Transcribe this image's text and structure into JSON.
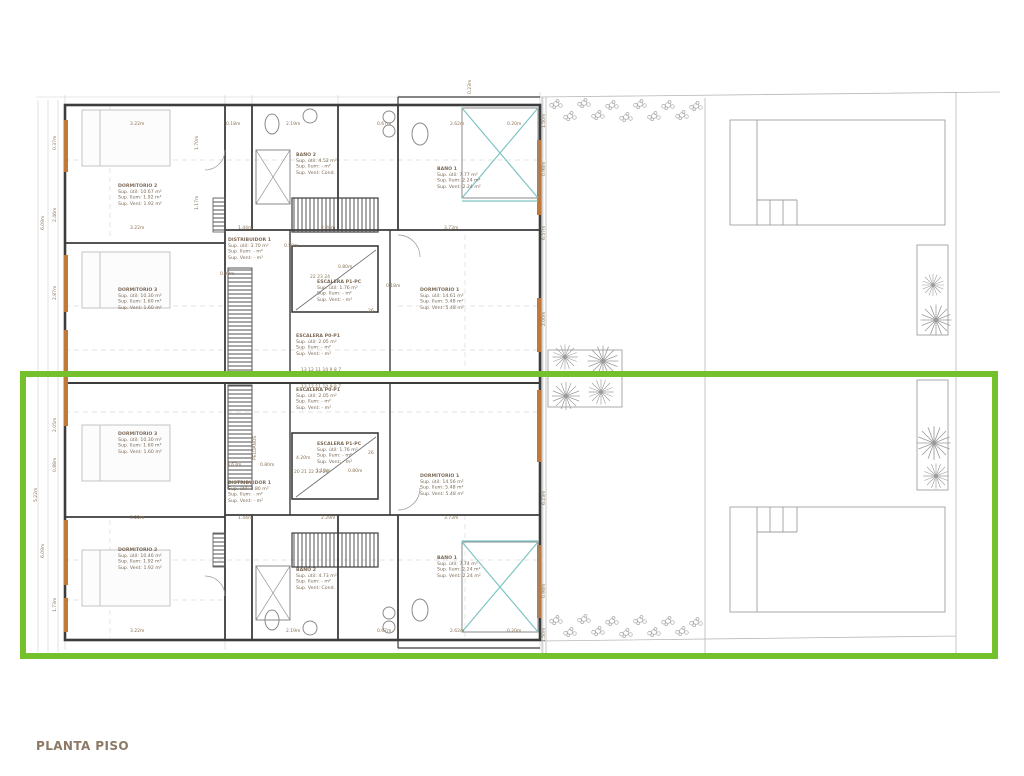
{
  "title": "PLANTA PISO",
  "colors": {
    "highlight_green": "#74c12d",
    "wall_dark": "#3c3c3c",
    "window_orange": "#c1793a",
    "fixture_teal": "#7fc4c4",
    "annotation_brown": "#8a7355",
    "title_brown": "#8c7a66"
  },
  "rooms": [
    {
      "x": 118,
      "y": 183,
      "name": "DORMITORIO 2",
      "lines": [
        "Sup. útil: 10.67 m²",
        "Sup. Ilum: 1.92 m²",
        "Sup. Vent: 1.92 m²"
      ]
    },
    {
      "x": 296,
      "y": 152,
      "name": "BAÑO 2",
      "lines": [
        "Sup. útil: 4.52 m²",
        "Sup. Ilum: - m²",
        "Sup. Vent: Cond."
      ]
    },
    {
      "x": 437,
      "y": 166,
      "name": "BAÑO 1",
      "lines": [
        "Sup. útil: 7.77 m²",
        "Sup. Ilum: 2.24 m²",
        "Sup. Vent: 2.24 m²"
      ]
    },
    {
      "x": 228,
      "y": 237,
      "name": "DISTRIBUIDOR 1",
      "lines": [
        "Sup. útil: 3.70 m²",
        "Sup. Ilum: - m²",
        "Sup. Vent: - m²"
      ]
    },
    {
      "x": 317,
      "y": 279,
      "name": "ESCALERA P1-PC",
      "lines": [
        "Sup. útil: 1.76 m²",
        "Sup. Ilum: - m²",
        "Sup. Vent: - m²"
      ]
    },
    {
      "x": 118,
      "y": 287,
      "name": "DORMITORIO 3",
      "lines": [
        "Sup. útil: 10.30 m²",
        "Sup. Ilum: 1.60 m²",
        "Sup. Vent: 1.60 m²"
      ]
    },
    {
      "x": 420,
      "y": 287,
      "name": "DORMITORIO 1",
      "lines": [
        "Sup. útil: 14.61 m²",
        "Sup. Ilum: 5.48 m²",
        "Sup. Vent: 5.48 m²"
      ]
    },
    {
      "x": 296,
      "y": 333,
      "name": "ESCALERA P0-P1",
      "lines": [
        "Sup. útil: 2.05 m²",
        "Sup. Ilum: - m²",
        "Sup. Vent: - m²"
      ]
    },
    {
      "x": 296,
      "y": 387,
      "name": "ESCALERA P0-P1",
      "lines": [
        "Sup. útil: 2.05 m²",
        "Sup. Ilum: - m²",
        "Sup. Vent: - m²"
      ]
    },
    {
      "x": 118,
      "y": 431,
      "name": "DORMITORIO 3",
      "lines": [
        "Sup. útil: 10.30 m²",
        "Sup. Ilum: 1.60 m²",
        "Sup. Vent: 1.60 m²"
      ]
    },
    {
      "x": 317,
      "y": 441,
      "name": "ESCALERA P1-PC",
      "lines": [
        "Sup. útil: 1.76 m²",
        "Sup. Ilum: - m²",
        "Sup. Vent: - m²"
      ]
    },
    {
      "x": 228,
      "y": 480,
      "name": "DISTRIBUIDOR 1",
      "lines": [
        "Sup. útil: 3.80 m²",
        "Sup. Ilum: - m²",
        "Sup. Vent: - m²"
      ]
    },
    {
      "x": 420,
      "y": 473,
      "name": "DORMITORIO 1",
      "lines": [
        "Sup. útil: 14.56 m²",
        "Sup. Ilum: 5.48 m²",
        "Sup. Vent: 5.48 m²"
      ]
    },
    {
      "x": 118,
      "y": 547,
      "name": "DORMITORIO 2",
      "lines": [
        "Sup. útil: 10.46 m²",
        "Sup. Ilum: 1.92 m²",
        "Sup. Vent: 1.92 m²"
      ]
    },
    {
      "x": 296,
      "y": 567,
      "name": "BAÑO 2",
      "lines": [
        "Sup. útil: 4.73 m²",
        "Sup. Ilum: - m²",
        "Sup. Vent: Cond."
      ]
    },
    {
      "x": 437,
      "y": 555,
      "name": "BAÑO 1",
      "lines": [
        "Sup. útil: 7.74 m²",
        "Sup. Ilum: 2.24 m²",
        "Sup. Vent: 2.24 m²"
      ]
    }
  ],
  "dimensions": [
    {
      "t": "3.22m",
      "x": 130,
      "y": 121,
      "r": 0
    },
    {
      "t": "0.18m",
      "x": 226,
      "y": 121,
      "r": 0
    },
    {
      "t": "2.19m",
      "x": 286,
      "y": 121,
      "r": 0
    },
    {
      "t": "0.67m",
      "x": 377,
      "y": 121,
      "r": 0
    },
    {
      "t": "2.62m",
      "x": 450,
      "y": 121,
      "r": 0
    },
    {
      "t": "0.20m",
      "x": 507,
      "y": 121,
      "r": 0
    },
    {
      "t": "3.22m",
      "x": 130,
      "y": 225,
      "r": 0
    },
    {
      "t": "1.44m",
      "x": 238,
      "y": 225,
      "r": 0
    },
    {
      "t": "2.28m",
      "x": 321,
      "y": 225,
      "r": 0
    },
    {
      "t": "3.73m",
      "x": 444,
      "y": 225,
      "r": 0
    },
    {
      "t": "0.59m",
      "x": 284,
      "y": 243,
      "r": 0
    },
    {
      "t": "0.90m",
      "x": 220,
      "y": 271,
      "r": 0
    },
    {
      "t": "0.80m",
      "x": 338,
      "y": 264,
      "r": 0
    },
    {
      "t": "0.18m",
      "x": 386,
      "y": 283,
      "r": 0
    },
    {
      "t": "22 23 24",
      "x": 310,
      "y": 274,
      "r": 0
    },
    {
      "t": "26",
      "x": 368,
      "y": 308,
      "r": 0
    },
    {
      "t": "13 12 11 10 9 8 7",
      "x": 301,
      "y": 367,
      "r": 0
    },
    {
      "t": "13 12 11 10 9 8 7",
      "x": 301,
      "y": 384,
      "r": 0
    },
    {
      "t": "26",
      "x": 368,
      "y": 450,
      "r": 0
    },
    {
      "t": "4.20m",
      "x": 296,
      "y": 455,
      "r": 0
    },
    {
      "t": "3.63m",
      "x": 227,
      "y": 462,
      "r": 0
    },
    {
      "t": "0.80m",
      "x": 260,
      "y": 462,
      "r": 0
    },
    {
      "t": "1.10m",
      "x": 316,
      "y": 468,
      "r": 0
    },
    {
      "t": "0.80m",
      "x": 348,
      "y": 468,
      "r": 0
    },
    {
      "t": "20 21 22 23 24",
      "x": 294,
      "y": 469,
      "r": 0
    },
    {
      "t": "3.22m",
      "x": 130,
      "y": 515,
      "r": 0
    },
    {
      "t": "1.44m",
      "x": 238,
      "y": 515,
      "r": 0
    },
    {
      "t": "2.29m",
      "x": 321,
      "y": 515,
      "r": 0
    },
    {
      "t": "3.73m",
      "x": 444,
      "y": 515,
      "r": 0
    },
    {
      "t": "3.22m",
      "x": 130,
      "y": 628,
      "r": 0
    },
    {
      "t": "2.19m",
      "x": 286,
      "y": 628,
      "r": 0
    },
    {
      "t": "0.67m",
      "x": 377,
      "y": 628,
      "r": 0
    },
    {
      "t": "2.62m",
      "x": 450,
      "y": 628,
      "r": 0
    },
    {
      "t": "0.20m",
      "x": 507,
      "y": 628,
      "r": 0
    },
    {
      "t": "0.37m",
      "x": 52,
      "y": 150,
      "r": -90
    },
    {
      "t": "6.09m",
      "x": 40,
      "y": 230,
      "r": -90
    },
    {
      "t": "2.46m",
      "x": 52,
      "y": 222,
      "r": -90
    },
    {
      "t": "2.87m",
      "x": 52,
      "y": 300,
      "r": -90
    },
    {
      "t": "5.22m",
      "x": 33,
      "y": 502,
      "r": -90
    },
    {
      "t": "2.05m",
      "x": 52,
      "y": 432,
      "r": -90
    },
    {
      "t": "0.88m",
      "x": 52,
      "y": 472,
      "r": -90
    },
    {
      "t": "6.09m",
      "x": 40,
      "y": 558,
      "r": -90
    },
    {
      "t": "1.73m",
      "x": 52,
      "y": 612,
      "r": -90
    },
    {
      "t": "1.70m",
      "x": 194,
      "y": 150,
      "r": -90
    },
    {
      "t": "1.17m",
      "x": 194,
      "y": 210,
      "r": -90
    },
    {
      "t": "0.23m",
      "x": 467,
      "y": 94,
      "r": -90
    },
    {
      "t": "1.50m",
      "x": 541,
      "y": 128,
      "r": -90
    },
    {
      "t": "0.98m",
      "x": 541,
      "y": 176,
      "r": -90
    },
    {
      "t": "6.57m",
      "x": 541,
      "y": 240,
      "r": -90
    },
    {
      "t": "2.00m",
      "x": 541,
      "y": 326,
      "r": -90
    },
    {
      "t": "6.23m",
      "x": 541,
      "y": 505,
      "r": -90
    },
    {
      "t": "0.98m",
      "x": 541,
      "y": 598,
      "r": -90
    },
    {
      "t": "1.50m",
      "x": 541,
      "y": 642,
      "r": -90
    },
    {
      "t": "PELDAÑOS",
      "x": 252,
      "y": 460,
      "r": -90
    }
  ]
}
